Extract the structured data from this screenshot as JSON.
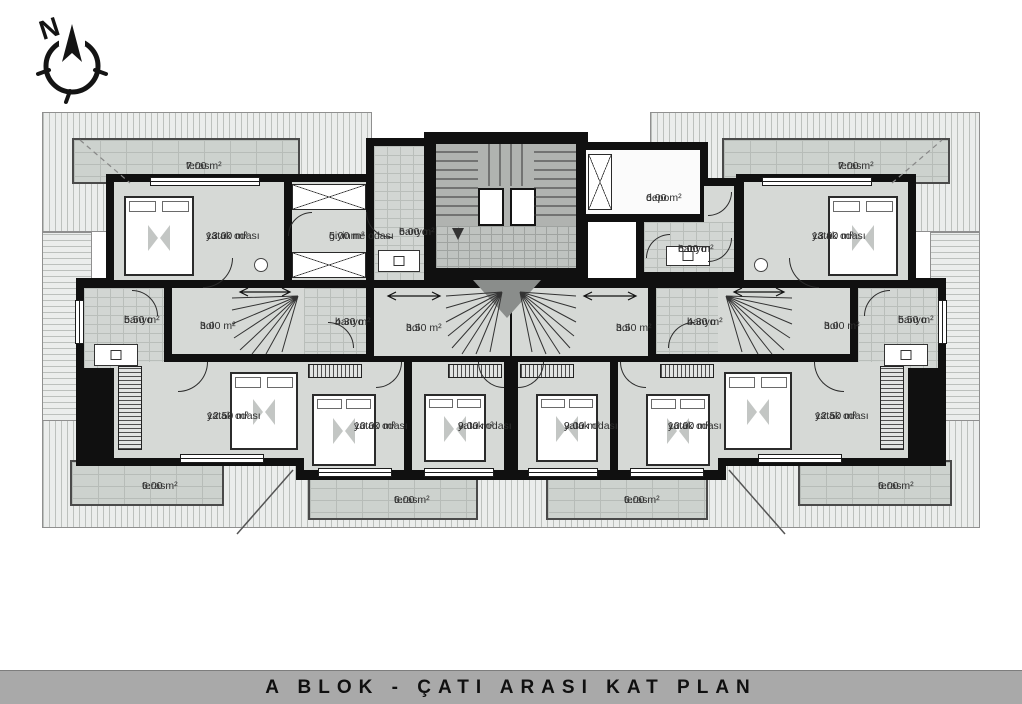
{
  "title": "A BLOK - ÇATI ARASI KAT PLAN",
  "compass": {
    "label": "N"
  },
  "rooms": [
    {
      "name": "teras",
      "area": "7.00 m²"
    },
    {
      "name": "yatak odası",
      "area": "13.00 m²"
    },
    {
      "name": "giyinme odası",
      "area": "5.00 m²"
    },
    {
      "name": "banyo",
      "area": "6.00 m²"
    },
    {
      "name": "depo",
      "area": "6.00 m²"
    },
    {
      "name": "banyo",
      "area": "6.00 m²"
    },
    {
      "name": "yatak odası",
      "area": "13.00 m²"
    },
    {
      "name": "teras",
      "area": "7.00 m²"
    },
    {
      "name": "banyo",
      "area": "5.50 m²"
    },
    {
      "name": "hol",
      "area": "3.00 m²"
    },
    {
      "name": "banyo",
      "area": "4.30 m²"
    },
    {
      "name": "hol",
      "area": "3.50 m²"
    },
    {
      "name": "hol",
      "area": "3.50 m²"
    },
    {
      "name": "banyo",
      "area": "4.30 m²"
    },
    {
      "name": "hol",
      "area": "3.00 m²"
    },
    {
      "name": "banyo",
      "area": "5.50 m²"
    },
    {
      "name": "yatak odası",
      "area": "12.50 m²"
    },
    {
      "name": "yatak odası",
      "area": "10.00 m²"
    },
    {
      "name": "yatak odası",
      "area": "9.00 m²"
    },
    {
      "name": "yatak odası",
      "area": "9.00 m²"
    },
    {
      "name": "yatak odası",
      "area": "10.00 m²"
    },
    {
      "name": "yatak odası",
      "area": "12.50 m²"
    },
    {
      "name": "teras",
      "area": "6.00 m²"
    },
    {
      "name": "teras",
      "area": "6.00 m²"
    },
    {
      "name": "teras",
      "area": "6.00 m²"
    },
    {
      "name": "teras",
      "area": "6.00 m²"
    }
  ]
}
